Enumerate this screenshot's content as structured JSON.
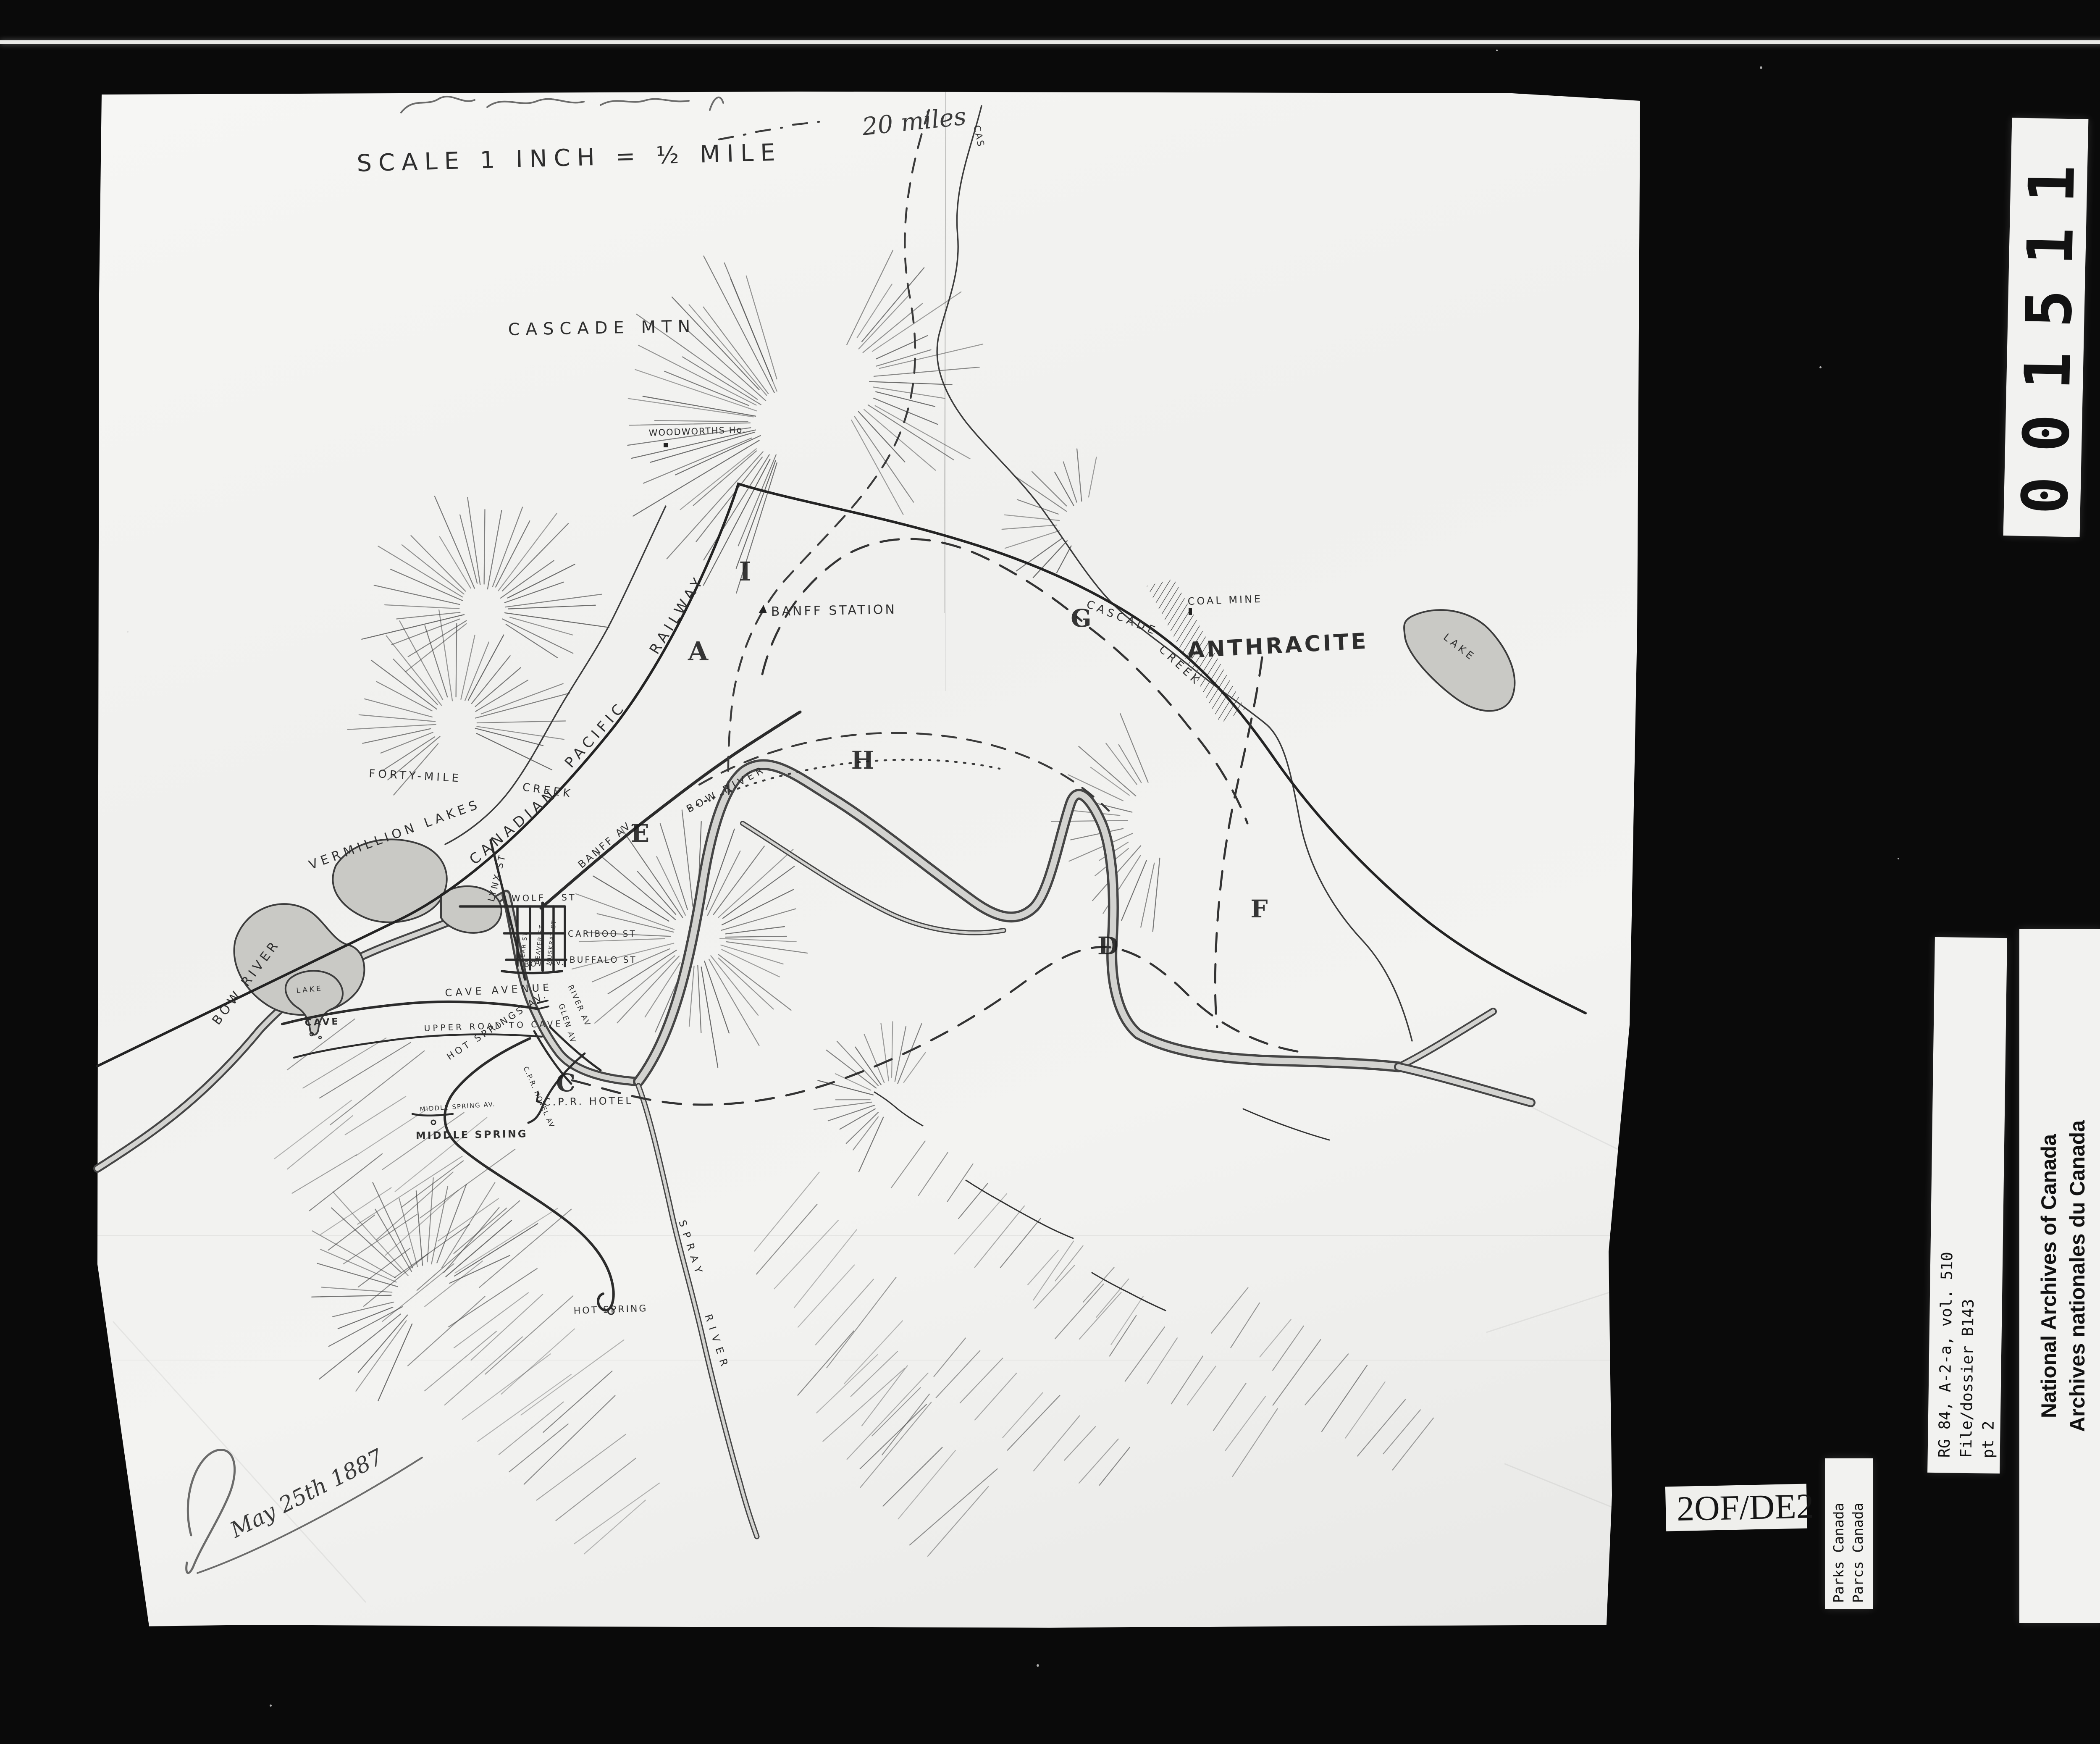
{
  "frame": {
    "film_number": "001511",
    "page_label": {
      "left": "2",
      "middle": "OF/DE",
      "right": "2"
    },
    "archives_label": {
      "line1": "National Archives of Canada",
      "line2": "Archives nationales du Canada"
    },
    "reference_label": {
      "line1": "RG 84, A-2-a, vol. 510",
      "line2": "File/dossier B143",
      "line3": "pt 2"
    },
    "parks_label": {
      "line1": "Parks Canada",
      "line2": "Parcs Canada"
    }
  },
  "map": {
    "scale_note": "SCALE 1 INCH = ½ MILE",
    "annotations": {
      "top_note": "20 miles",
      "signature": "May 25th 1887"
    },
    "labels": {
      "cas_fragment": "CAS",
      "cascade_mtn": "CASCADE MTN",
      "woodworths": "WOODWORTHS Ho.",
      "railway_word1": "CANADIAN",
      "railway_word2": "PACIFIC",
      "railway_word3": "RAILWAY",
      "banff_station": "BANFF STATION",
      "cascade_creek_word1": "CASCADE",
      "cascade_creek_word2": "CREEK",
      "coal_mine": "COAL MINE",
      "anthracite": "ANTHRACITE",
      "anthracite_lake": "LAKE",
      "forty_mile_1": "FORTY-MILE",
      "forty_mile_2": "CREEK",
      "vermillion_lakes": "VERMILLION LAKES",
      "bow_river_west": "BOW RIVER",
      "bow_river_mid": "BOW RIVER",
      "banff_av": "BANFF AV.",
      "lynx_st": "LYNX ST",
      "wolf_st": "WOLF ST",
      "cariboo_st": "CARIBOO ST",
      "buffalo_st": "BUFFALO ST",
      "bow_av": "BOW AV.",
      "bear_st": "BEAR ST",
      "beaver_st": "BEAVER ST",
      "muskrat_st": "MUSKRAT ST",
      "river_av": "RIVER AV",
      "glen_av": "GLEN AV",
      "cave_avenue": "CAVE AVENUE",
      "upper_road": "UPPER ROAD TO CAVE",
      "cave_lake": "LAKE",
      "cave": "CAVE",
      "hot_springs_av": "HOT SPRINGS AV.",
      "middle_spring_av": "MIDDLE SPRING AV.",
      "middle_spring": "MIDDLE SPRING",
      "cpr_hotel_av": "C.P.R. HOTEL AV",
      "cpr_hotel": "C.P.R. HOTEL",
      "hot_spring": "HOT SPRING",
      "spray_1": "SPRAY",
      "spray_2": "RIVER"
    },
    "markers": {
      "a": "A",
      "c": "C",
      "d": "D",
      "e": "E",
      "f": "F",
      "g": "G",
      "h": "H",
      "i": "I"
    }
  }
}
